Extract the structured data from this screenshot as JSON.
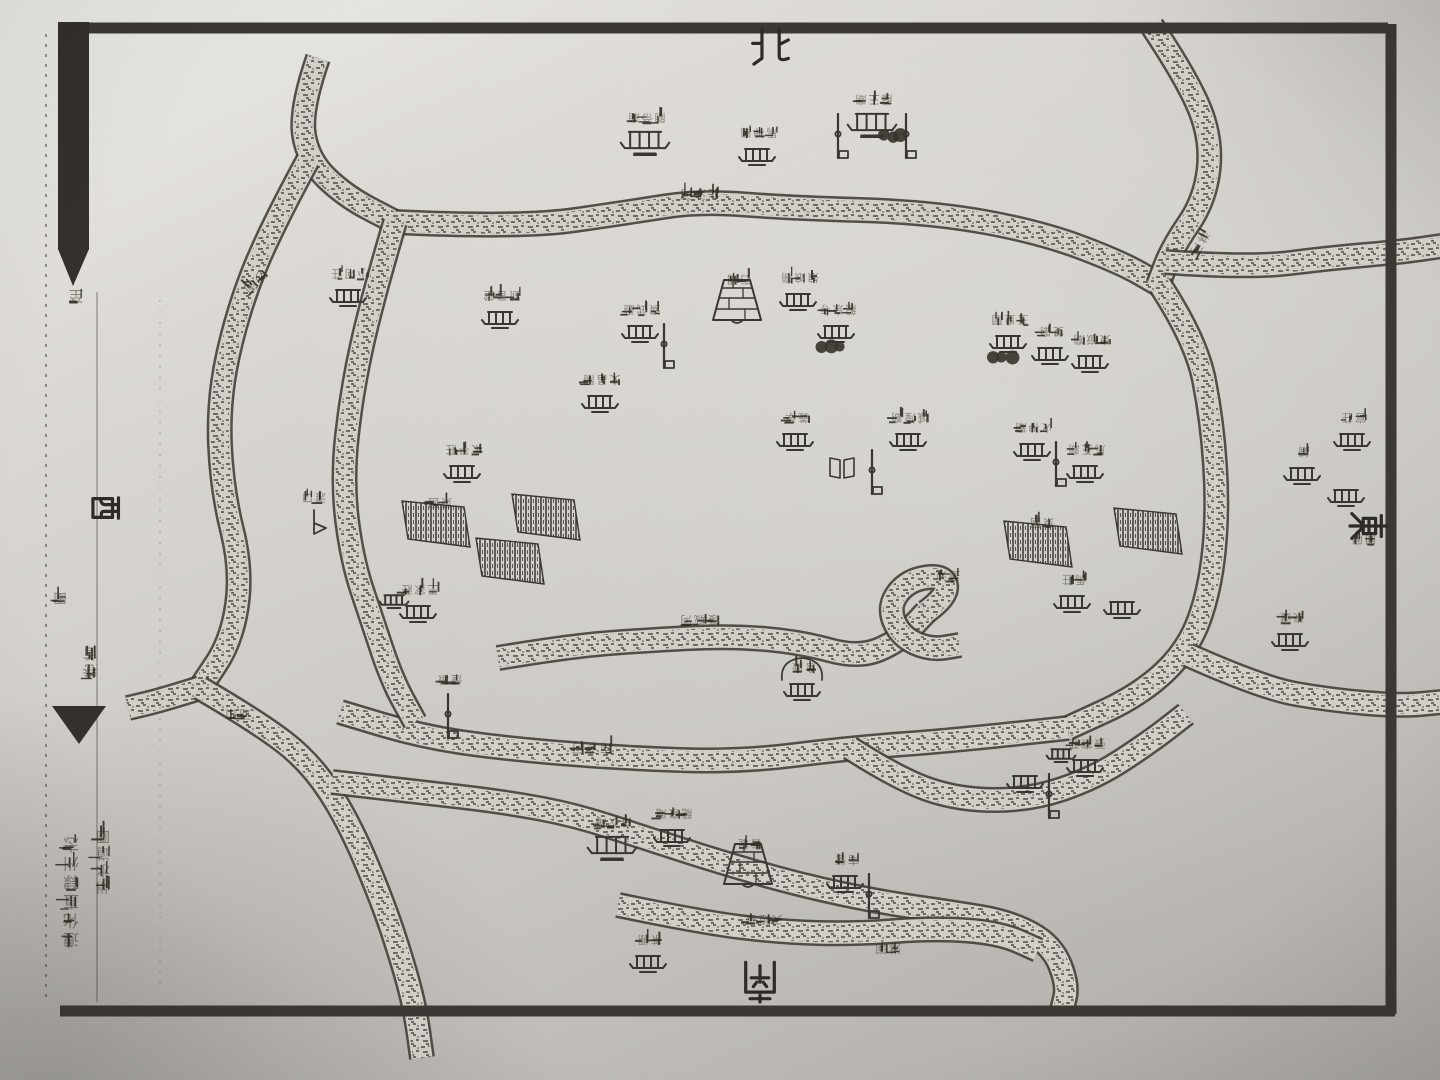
{
  "page": {
    "description": "scanned woodblock-print gazetteer map page, photographed; most labels printed upside-down",
    "ink_color": "#3a3632",
    "paper_color": "#d2cfc9",
    "frame_color": "#3c3834"
  },
  "compass": {
    "north": "北",
    "south": "南",
    "east": "東",
    "west": "西"
  },
  "binding_margin": {
    "page_char": "至",
    "section_char": "圖",
    "volume_chars": "卷首",
    "title_inner": "州水道圖",
    "title_outer": "遵化直隸州志"
  },
  "map": {
    "rivers": [
      {
        "name": "top-left-stream",
        "pts": [
          [
            318,
            58
          ],
          [
            300,
            110
          ],
          [
            308,
            160
          ],
          [
            345,
            196
          ],
          [
            395,
            222
          ]
        ]
      },
      {
        "name": "north-moat",
        "pts": [
          [
            395,
            222
          ],
          [
            520,
            228
          ],
          [
            630,
            212
          ],
          [
            700,
            201
          ],
          [
            790,
            208
          ],
          [
            930,
            212
          ],
          [
            1040,
            232
          ],
          [
            1120,
            262
          ],
          [
            1160,
            285
          ]
        ]
      },
      {
        "name": "northeast-stream",
        "pts": [
          [
            1152,
            26
          ],
          [
            1188,
            80
          ],
          [
            1212,
            140
          ],
          [
            1205,
            200
          ],
          [
            1172,
            248
          ],
          [
            1158,
            285
          ]
        ]
      },
      {
        "name": "east-branch-out",
        "pts": [
          [
            1165,
            262
          ],
          [
            1250,
            268
          ],
          [
            1330,
            258
          ],
          [
            1400,
            252
          ],
          [
            1442,
            246
          ]
        ]
      },
      {
        "name": "east-moat",
        "pts": [
          [
            1160,
            285
          ],
          [
            1196,
            340
          ],
          [
            1212,
            420
          ],
          [
            1218,
            510
          ],
          [
            1210,
            590
          ],
          [
            1188,
            650
          ],
          [
            1140,
            695
          ],
          [
            1068,
            728
          ]
        ]
      },
      {
        "name": "east-exit",
        "pts": [
          [
            1188,
            655
          ],
          [
            1262,
            688
          ],
          [
            1330,
            700
          ],
          [
            1400,
            706
          ],
          [
            1442,
            702
          ]
        ]
      },
      {
        "name": "south-moat",
        "pts": [
          [
            1068,
            728
          ],
          [
            960,
            740
          ],
          [
            850,
            748
          ],
          [
            740,
            762
          ],
          [
            620,
            758
          ],
          [
            500,
            748
          ],
          [
            420,
            736
          ],
          [
            340,
            712
          ]
        ]
      },
      {
        "name": "west-inner",
        "pts": [
          [
            395,
            222
          ],
          [
            372,
            300
          ],
          [
            352,
            390
          ],
          [
            342,
            480
          ],
          [
            352,
            560
          ],
          [
            372,
            620
          ],
          [
            392,
            680
          ],
          [
            415,
            722
          ]
        ]
      },
      {
        "name": "west-outer",
        "pts": [
          [
            308,
            160
          ],
          [
            270,
            230
          ],
          [
            238,
            310
          ],
          [
            218,
            400
          ],
          [
            222,
            490
          ],
          [
            242,
            570
          ],
          [
            232,
            640
          ],
          [
            200,
            688
          ]
        ]
      },
      {
        "name": "west-exit",
        "pts": [
          [
            200,
            688
          ],
          [
            162,
            700
          ],
          [
            128,
            708
          ]
        ]
      },
      {
        "name": "southwest-stream",
        "pts": [
          [
            200,
            688
          ],
          [
            258,
            722
          ],
          [
            310,
            762
          ],
          [
            348,
            820
          ],
          [
            382,
            900
          ],
          [
            402,
            960
          ],
          [
            415,
            1008
          ],
          [
            422,
            1058
          ]
        ]
      },
      {
        "name": "mid-channel",
        "pts": [
          [
            498,
            658
          ],
          [
            570,
            646
          ],
          [
            650,
            640
          ],
          [
            730,
            636
          ],
          [
            800,
            642
          ],
          [
            858,
            658
          ],
          [
            898,
            642
          ],
          [
            926,
            612
          ]
        ]
      },
      {
        "name": "pond-loop",
        "pts": [
          [
            926,
            612
          ],
          [
            948,
            596
          ],
          [
            944,
            575
          ],
          [
            908,
            580
          ],
          [
            888,
            606
          ],
          [
            900,
            636
          ],
          [
            930,
            650
          ],
          [
            960,
            645
          ]
        ]
      },
      {
        "name": "south-inner-band",
        "pts": [
          [
            332,
            782
          ],
          [
            420,
            792
          ],
          [
            505,
            802
          ],
          [
            575,
            815
          ],
          [
            645,
            838
          ],
          [
            720,
            862
          ],
          [
            800,
            885
          ],
          [
            880,
            902
          ],
          [
            950,
            912
          ],
          [
            1010,
            922
          ],
          [
            1052,
            945
          ],
          [
            1068,
            985
          ],
          [
            1062,
            1010
          ]
        ]
      },
      {
        "name": "south-band-2",
        "pts": [
          [
            618,
            905
          ],
          [
            700,
            922
          ],
          [
            780,
            932
          ],
          [
            855,
            934
          ],
          [
            935,
            928
          ],
          [
            1000,
            933
          ],
          [
            1038,
            950
          ]
        ]
      },
      {
        "name": "southeast-link",
        "pts": [
          [
            850,
            748
          ],
          [
            900,
            780
          ],
          [
            960,
            800
          ],
          [
            1030,
            800
          ],
          [
            1095,
            778
          ],
          [
            1150,
            742
          ],
          [
            1186,
            714
          ]
        ]
      }
    ],
    "river_labels": [
      {
        "text": "沙河",
        "x": 255,
        "y": 282,
        "rot": 135
      },
      {
        "text": "北沙河",
        "x": 700,
        "y": 194,
        "rot": 180
      },
      {
        "text": "淋河",
        "x": 1200,
        "y": 243,
        "rot": 120
      },
      {
        "text": "護城河",
        "x": 700,
        "y": 620,
        "rot": 180
      },
      {
        "text": "南沙河",
        "x": 592,
        "y": 748,
        "rot": 180
      },
      {
        "text": "淋河",
        "x": 888,
        "y": 948,
        "rot": 180
      },
      {
        "text": "河口",
        "x": 238,
        "y": 714,
        "rot": 180
      }
    ],
    "features": [
      {
        "t": "temple",
        "x": 645,
        "y": 140,
        "label": "關帝廟"
      },
      {
        "t": "house",
        "x": 757,
        "y": 155,
        "label": "馬神廟"
      },
      {
        "t": "twinflag",
        "x": 872,
        "y": 122,
        "label": "龍王廟"
      },
      {
        "t": "house",
        "x": 348,
        "y": 296,
        "label": "小河莊"
      },
      {
        "t": "house",
        "x": 500,
        "y": 318,
        "label": "觀音堂"
      },
      {
        "t": "flaghouse",
        "x": 640,
        "y": 332,
        "label": "演武廳"
      },
      {
        "t": "dam",
        "x": 737,
        "y": 302,
        "label": "石閘"
      },
      {
        "t": "house",
        "x": 798,
        "y": 300,
        "label": "娘娘廟"
      },
      {
        "t": "treehouse",
        "x": 836,
        "y": 332,
        "label": "龍泉寺"
      },
      {
        "t": "treehouse",
        "x": 1008,
        "y": 342,
        "label": "玉皇閣"
      },
      {
        "t": "house",
        "x": 1050,
        "y": 354,
        "label": "雙廟"
      },
      {
        "t": "house",
        "x": 1090,
        "y": 362,
        "label": "東嶽廟"
      },
      {
        "t": "house",
        "x": 600,
        "y": 402,
        "label": "文昌閣"
      },
      {
        "t": "house",
        "x": 795,
        "y": 440,
        "label": "義學"
      },
      {
        "t": "book",
        "x": 842,
        "y": 468,
        "label": ""
      },
      {
        "t": "flag",
        "x": 872,
        "y": 458,
        "label": ""
      },
      {
        "t": "house",
        "x": 908,
        "y": 440,
        "label": "城隍廟"
      },
      {
        "t": "flaghouse",
        "x": 1032,
        "y": 450,
        "label": "火神廟"
      },
      {
        "t": "house",
        "x": 1085,
        "y": 472,
        "label": "馬王廟"
      },
      {
        "t": "house",
        "x": 462,
        "y": 472,
        "label": "太平莊"
      },
      {
        "t": "hatch",
        "x": 438,
        "y": 525,
        "label": "菜園"
      },
      {
        "t": "hatch",
        "x": 548,
        "y": 518,
        "label": ""
      },
      {
        "t": "hatch",
        "x": 512,
        "y": 562,
        "label": ""
      },
      {
        "t": "boat",
        "x": 312,
        "y": 520,
        "label": "渡口"
      },
      {
        "t": "cluster",
        "x": 418,
        "y": 612,
        "label": "王家莊"
      },
      {
        "t": "hatch",
        "x": 1040,
        "y": 545,
        "label": "東園"
      },
      {
        "t": "hatch",
        "x": 1150,
        "y": 532,
        "label": ""
      },
      {
        "t": "house",
        "x": 1072,
        "y": 602,
        "label": "馬莊"
      },
      {
        "t": "house",
        "x": 1122,
        "y": 608,
        "label": ""
      },
      {
        "t": "label",
        "x": 946,
        "y": 598,
        "label": "蓮池"
      },
      {
        "t": "enclosurehouse",
        "x": 802,
        "y": 690,
        "label": "倉廒"
      },
      {
        "t": "flag",
        "x": 448,
        "y": 702,
        "label": "煙墩"
      },
      {
        "t": "temple",
        "x": 612,
        "y": 845,
        "label": "白衣庵"
      },
      {
        "t": "house",
        "x": 672,
        "y": 836,
        "label": "龍泉庵"
      },
      {
        "t": "dam",
        "x": 748,
        "y": 866,
        "label": "石堤"
      },
      {
        "t": "flaghouse",
        "x": 845,
        "y": 882,
        "label": "南營"
      },
      {
        "t": "house",
        "x": 648,
        "y": 962,
        "label": "茶棚"
      },
      {
        "t": "label",
        "x": 762,
        "y": 942,
        "label": "天燈臺"
      },
      {
        "t": "house",
        "x": 1290,
        "y": 640,
        "label": "東渡"
      },
      {
        "t": "house",
        "x": 1352,
        "y": 440,
        "label": "官莊"
      },
      {
        "t": "house",
        "x": 1302,
        "y": 474,
        "label": "鋪"
      },
      {
        "t": "house",
        "x": 1346,
        "y": 496,
        "label": ""
      },
      {
        "t": "label",
        "x": 1362,
        "y": 562,
        "label": "關廂"
      },
      {
        "t": "cluster",
        "x": 1085,
        "y": 766,
        "label": "張家莊"
      },
      {
        "t": "flaghouse",
        "x": 1025,
        "y": 782,
        "label": ""
      }
    ]
  }
}
